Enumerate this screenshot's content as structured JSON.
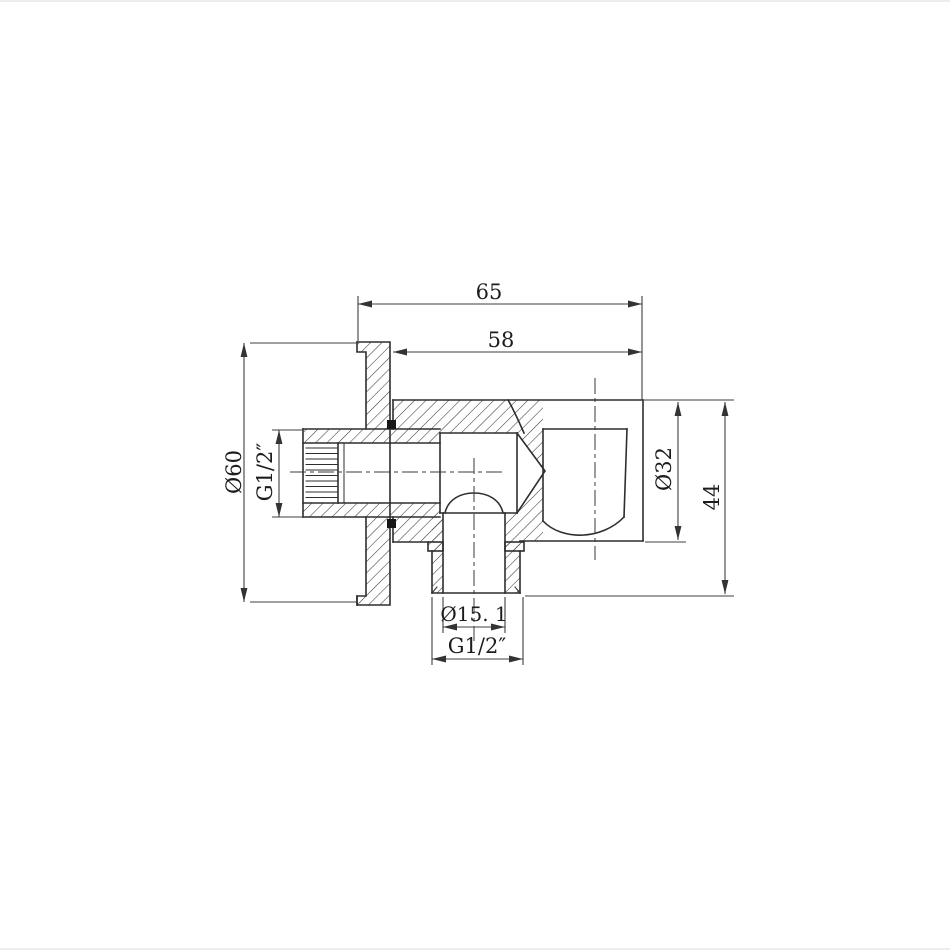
{
  "page": {
    "background": "#ffffff",
    "border_color": "#ededed"
  },
  "drawing": {
    "type": "technical-section-drawing",
    "line_color": "#2e2e2e",
    "dim_color": "#3f3f3f",
    "dimensions": {
      "total_depth": "65",
      "body_depth": "58",
      "flange_diameter": "Ø60",
      "inlet_thread": "G1/2″",
      "holder_diameter": "Ø32",
      "overall_height": "44",
      "outlet_bore": "Ø15. 1",
      "outlet_thread": "G1/2″"
    }
  }
}
